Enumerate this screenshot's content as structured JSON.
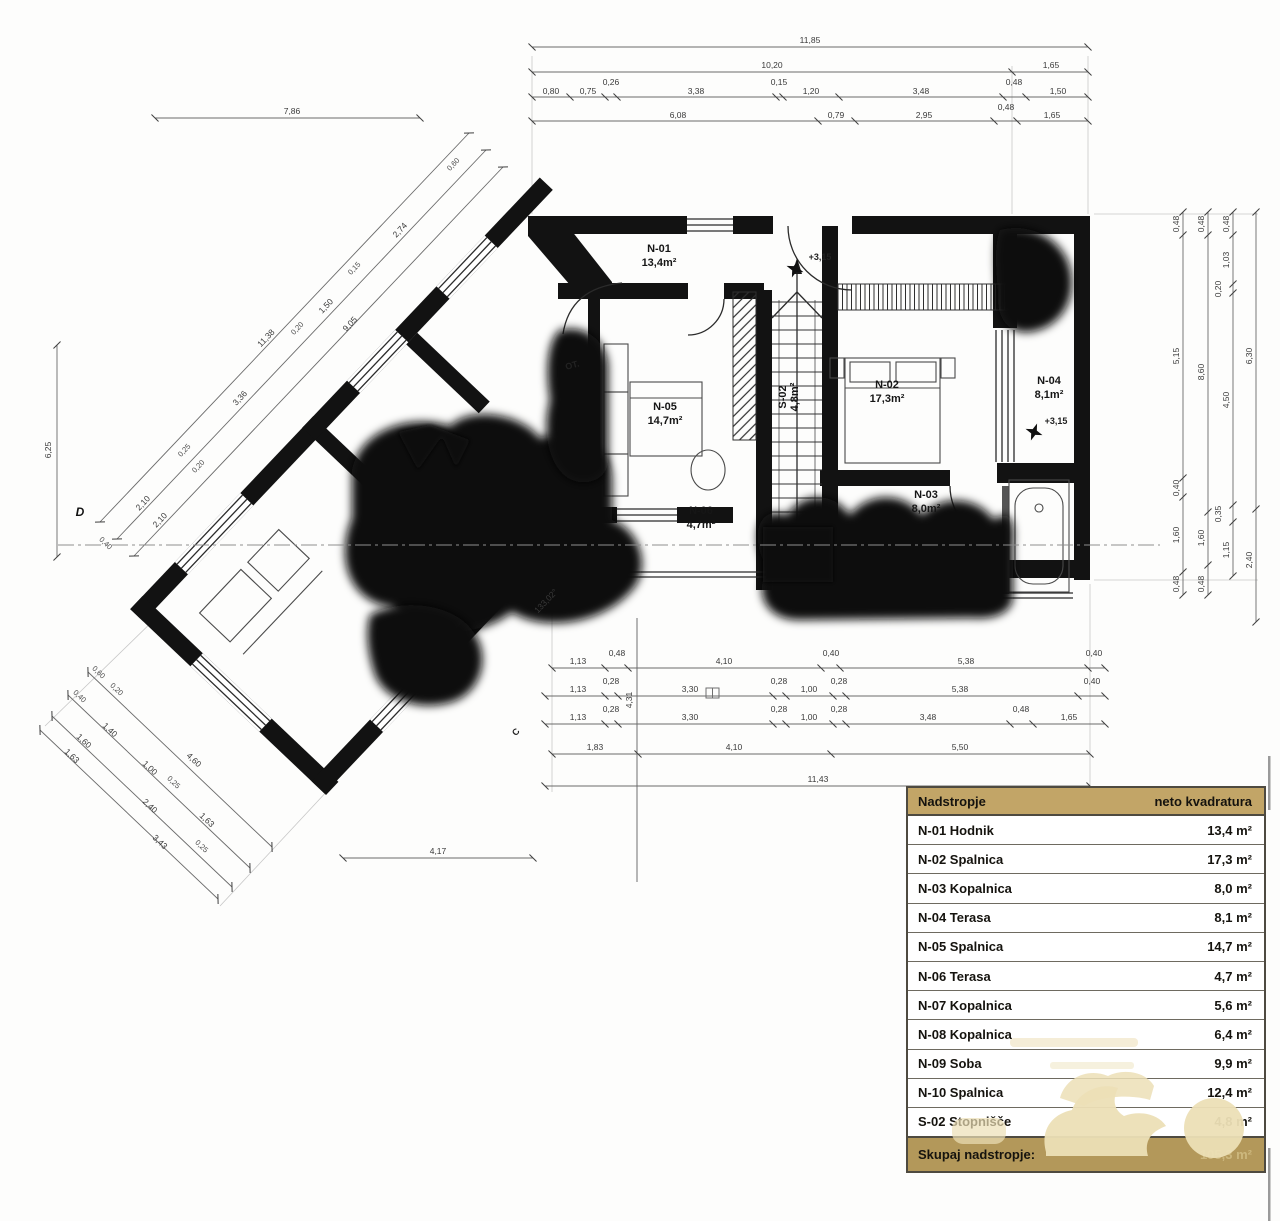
{
  "plan": {
    "rooms": {
      "n01": {
        "id": "N-01",
        "area": "13,4m²"
      },
      "n02": {
        "id": "N-02",
        "area": "17,3m²"
      },
      "n03": {
        "id": "N-03",
        "area": "8,0m²"
      },
      "n04": {
        "id": "N-04",
        "area": "8,1m²"
      },
      "n05": {
        "id": "N-05",
        "area": "14,7m²"
      },
      "n06": {
        "id": "N-06",
        "area": "4,7m²"
      },
      "s02": {
        "id": "S-02",
        "area": "4,8m²"
      }
    },
    "levels": {
      "stairs": "+3,15",
      "terrace": "+3,15"
    },
    "labels": {
      "angle": "133,02°",
      "ot": "OT.",
      "d": "D",
      "c": "C"
    }
  },
  "dims": {
    "top_total": "11,85",
    "top_r2": [
      "10,20",
      "1,65"
    ],
    "top_r3": [
      "0,80",
      "0,75",
      "0,26",
      "3,38",
      "0,15",
      "1,20",
      "3,48",
      "0,48",
      "1,50"
    ],
    "top_r4": [
      "6,08",
      "0,79",
      "2,95",
      "0,48",
      "1,65"
    ],
    "wing_top": "7,86",
    "right_c1": [
      "0,48",
      "5,15",
      "0,40",
      "1,60",
      "0,48"
    ],
    "right_c2": [
      "0,48",
      "8,60",
      "1,60",
      "0,48"
    ],
    "right_c3": [
      "0,48",
      "1,03",
      "0,20",
      "4,50",
      "0,35",
      "1,15"
    ],
    "right_c4": [
      "6,30",
      "2,40"
    ],
    "bot_r1": [
      "1,13",
      "0,48",
      "4,10",
      "0,40",
      "5,38",
      "0,40"
    ],
    "bot_r2": [
      "1,13",
      "0,28",
      "3,30",
      "0,28",
      "1,00",
      "0,28",
      "5,38",
      "0,40"
    ],
    "bot_r3": [
      "1,13",
      "0,28",
      "3,30",
      "0,28",
      "1,00",
      "0,28",
      "3,48",
      "0,48",
      "1,65"
    ],
    "bot_r4": [
      "1,83",
      "4,10",
      "5,50"
    ],
    "bot_total": "11,43",
    "wing_bottom": "4,17",
    "vert_mid": "4,31",
    "diagA_total": "11,38",
    "diagB": [
      "2,10",
      "0,25",
      "3,36",
      "0,20",
      "1,50",
      "0,15",
      "2,74",
      "0,60"
    ],
    "diagC": [
      "2,10",
      "0,20",
      "9,05"
    ],
    "low_l1": [
      "0,60",
      "0,20",
      "4,60"
    ],
    "low_l2": [
      "0,40",
      "1,40",
      "1,00",
      "0,25",
      "1,63"
    ],
    "low_l3": [
      "1,60",
      "2,40",
      "0,25"
    ],
    "low_l4": [
      "1,63",
      "3,43"
    ],
    "left_total": "6,25",
    "d_small": "0,40"
  },
  "table": {
    "header": {
      "col1": "Nadstropje",
      "col2": "neto kvadratura"
    },
    "rows": [
      {
        "name": "N-01 Hodnik",
        "value": "13,4 m²"
      },
      {
        "name": "N-02 Spalnica",
        "value": "17,3 m²"
      },
      {
        "name": "N-03 Kopalnica",
        "value": "8,0 m²"
      },
      {
        "name": "N-04 Terasa",
        "value": "8,1 m²"
      },
      {
        "name": "N-05 Spalnica",
        "value": "14,7 m²"
      },
      {
        "name": "N-06 Terasa",
        "value": "4,7 m²"
      },
      {
        "name": "N-07 Kopalnica",
        "value": "5,6 m²"
      },
      {
        "name": "N-08 Kopalnica",
        "value": "6,4 m²"
      },
      {
        "name": "N-09 Soba",
        "value": "9,9 m²"
      },
      {
        "name": "N-10 Spalnica",
        "value": "12,4 m²"
      },
      {
        "name": "S-02 Stopnišče",
        "value": "4,8 m²"
      }
    ],
    "footer": {
      "label": "Skupaj nadstropje:",
      "value": "105,3 m²"
    }
  }
}
